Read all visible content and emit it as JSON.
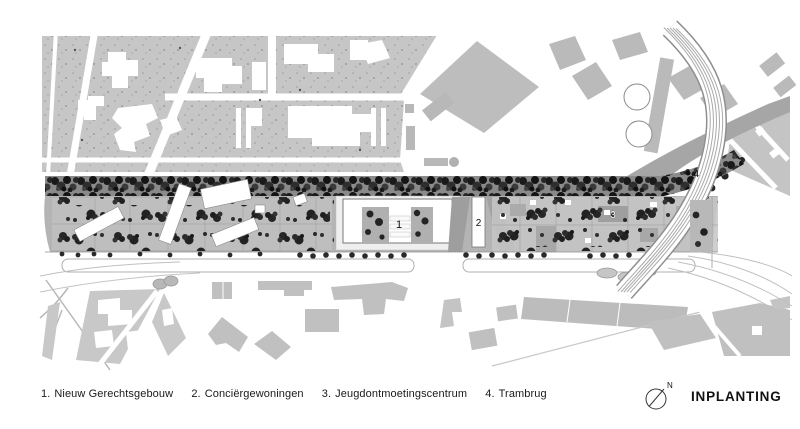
{
  "legend": {
    "items": [
      {
        "number": "1.",
        "label": "Nieuw Gerechtsgebouw"
      },
      {
        "number": "2.",
        "label": "Conciërgewoningen"
      },
      {
        "number": "3.",
        "label": "Jeugdontmoetingscentrum"
      },
      {
        "number": "4.",
        "label": "Trambrug"
      }
    ]
  },
  "title": {
    "label": "INPLANTING"
  },
  "compass": {
    "north_label": "N"
  },
  "plan": {
    "markers": {
      "building_1": "1",
      "building_2": "2",
      "building_3": "3",
      "bridge_4": "4"
    }
  },
  "colors": {
    "paper": "#ffffff",
    "block_gray": "#c6c6c6",
    "strip_gray": "#b4b4b4",
    "building_gray": "#c0c0c0",
    "embankment_gray": "#a6a6a6",
    "tree_dark": "#1f1f1f",
    "ink": "#1a1a1a"
  }
}
